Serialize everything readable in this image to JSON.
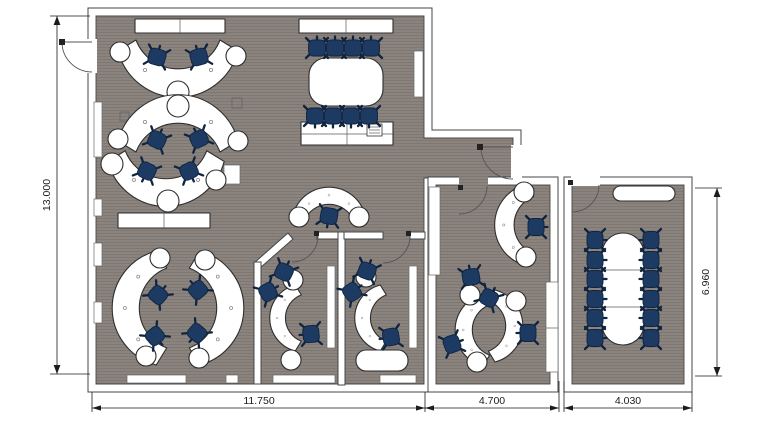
{
  "dimensions": {
    "overall_height": "13.000",
    "main_building_width": "11.750",
    "middle_room_width": "4.700",
    "right_room_width": "4.030",
    "right_rooms_height": "6.960"
  },
  "colors": {
    "background": "#ffffff",
    "floor": "#8b837d",
    "floor_line": "#7f7771",
    "wall_fill": "#ffffff",
    "wall_stroke": "#474747",
    "desk_fill": "#ffffff",
    "desk_stroke": "#2e2e2e",
    "chair_fill": "#1d3a63",
    "chair_stroke": "#0f2440",
    "door_stroke": "#555555",
    "dimension": "#1c1c1c"
  }
}
